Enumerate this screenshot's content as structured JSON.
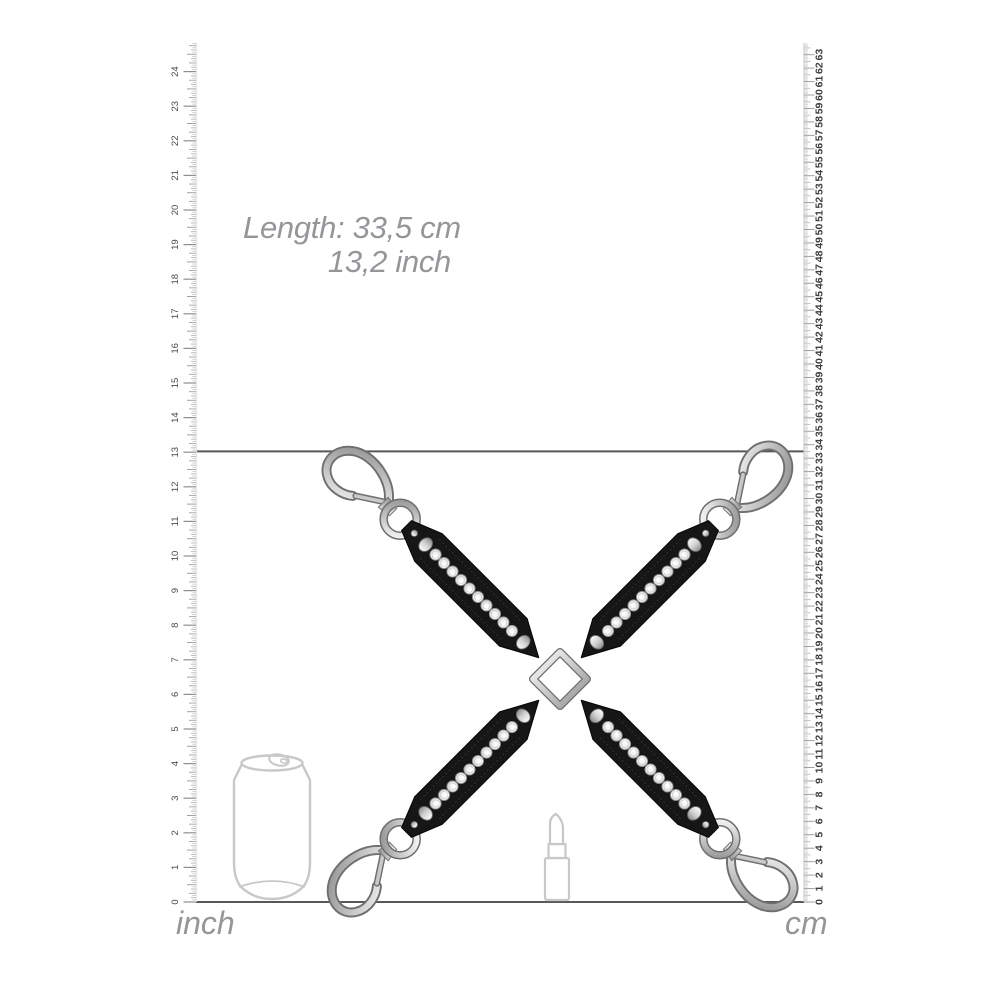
{
  "title": "Product measurement image",
  "annotation": {
    "line1": "Length: 33,5 cm",
    "line2": "13,2 inch"
  },
  "measurement": {
    "length_cm": 33.5,
    "length_inch": 13.2
  },
  "rulers": {
    "left": {
      "unit": "inch",
      "min": 0,
      "max": 24,
      "ticks_per_unit": 16
    },
    "right": {
      "unit": "cm",
      "min": 0,
      "max": 63,
      "ticks_per_unit": 10
    }
  },
  "product": {
    "name": "rhinestone-hogtie-cross",
    "straps": 4,
    "rhinestones_per_strap": 10,
    "dome_studs_per_strap": 2,
    "snap_hooks": 4,
    "colors": {
      "strap": "#161616",
      "metal_light": "#fdfdfd",
      "metal_mid": "#c9c9c9",
      "metal_dark": "#8e8e8e",
      "rhinestone": "#f4f4f4"
    }
  },
  "scale_references": [
    {
      "name": "soda-can-outline"
    },
    {
      "name": "lipstick-outline"
    }
  ],
  "colors": {
    "background": "#ffffff",
    "line": "#58585a",
    "annotation_text": "#96969a",
    "tick": "#a6a6a6",
    "tick_number_inch": "#4a4a4a",
    "tick_number_cm": "#3d3d3d",
    "outline_gray": "#c8c8c8"
  }
}
